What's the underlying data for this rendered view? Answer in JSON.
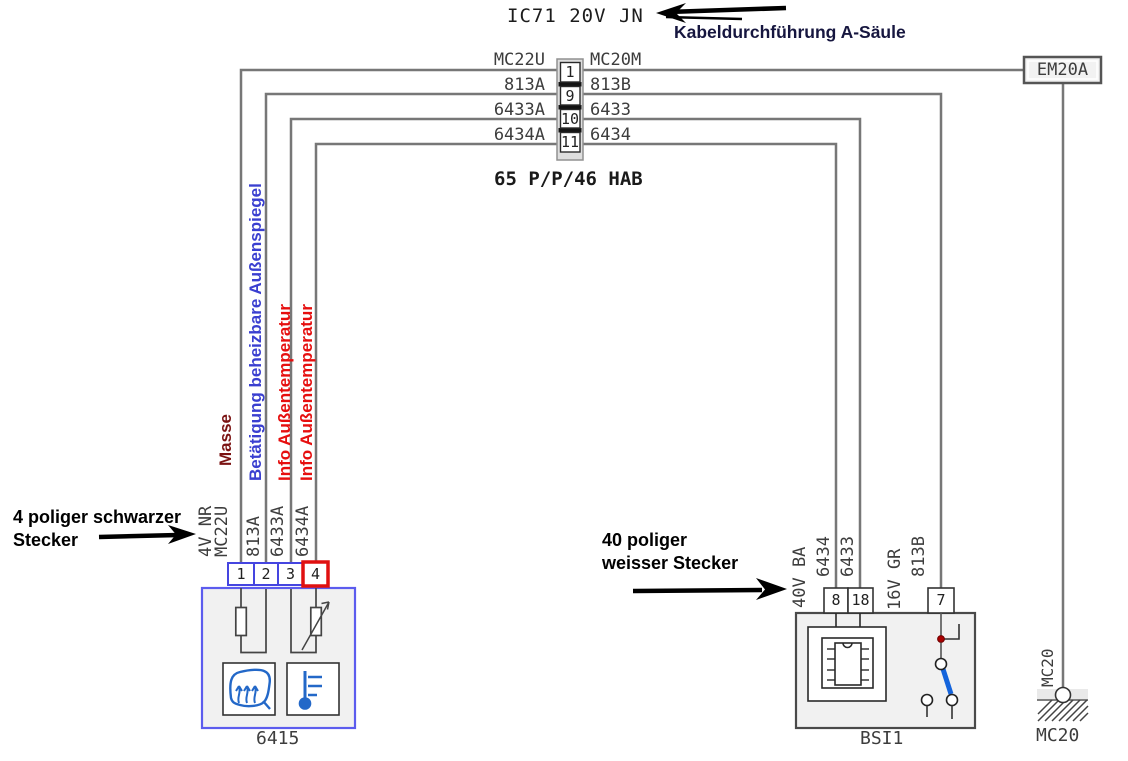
{
  "header": {
    "title": "IC71 20V JN",
    "callout": "Kabeldurchführung A-Säule"
  },
  "junction": {
    "caption": "65 P/P/46 HAB",
    "rows": [
      {
        "pin": "1",
        "left": "MC22U",
        "right": "MC20M"
      },
      {
        "pin": "9",
        "left": "813A",
        "right": "813B"
      },
      {
        "pin": "10",
        "left": "6433A",
        "right": "6433"
      },
      {
        "pin": "11",
        "left": "6434A",
        "right": "6434"
      }
    ]
  },
  "em20a_label": "EM20A",
  "ground": {
    "wire_label": "MC20",
    "name": "MC20"
  },
  "signals": [
    {
      "text": "Masse",
      "color": "#7a1212"
    },
    {
      "text": "Betätigung beheizbare Außenspiegel",
      "color": "#3a3fd0"
    },
    {
      "text": "Info Außentemperatur",
      "color": "#e60f0f"
    },
    {
      "text": "Info Außentemperatur",
      "color": "#e60f0f"
    }
  ],
  "device6415": {
    "name": "6415",
    "pins": [
      "1",
      "2",
      "3",
      "4"
    ],
    "wire_labels": [
      "4V NR",
      "MC22U",
      "813A",
      "6433A",
      "6434A"
    ]
  },
  "bsi": {
    "name": "BSI1",
    "pins": [
      "8",
      "18",
      "7"
    ],
    "wire_labels": [
      "40V BA",
      "6434",
      "6433",
      "16V GR",
      "813B"
    ]
  },
  "notes": {
    "left_line1": "4 poliger schwarzer",
    "left_line2": "Stecker",
    "right_line1": "40 poliger",
    "right_line2": "weisser Stecker"
  },
  "colors": {
    "wire": "#777777",
    "device_border_blue": "#5c5cee",
    "pin_highlight_red": "#e01010",
    "switch_blade_blue": "#1464dc",
    "icon_blue": "#2368c8",
    "junction_dot_red": "#aa0000"
  }
}
